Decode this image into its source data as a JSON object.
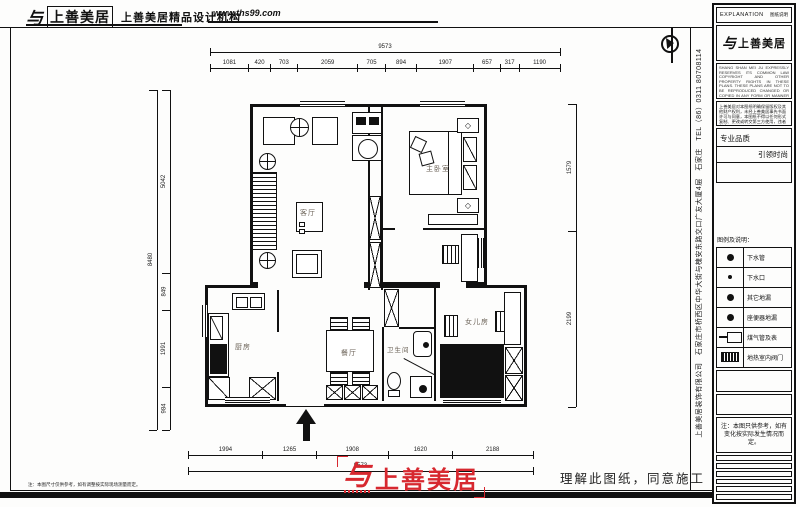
{
  "header": {
    "glyph": "与",
    "brand": "上善美居",
    "agency": "上善美居精品设计机构",
    "website": "www.ths99.com"
  },
  "panel": {
    "title_en": "EXPLANATION",
    "title_zh": "图纸说明",
    "logo_glyph": "与",
    "logo_text": "上善美居",
    "copyright_en": "SHANG SHAN MEI JU EXPRESSLY RESERVES ITS COMMON LAW COPYRIGHT AND OTHER PROPERTY RIGHTS IN THESE PLANS. THESE PLANS ARE NOT TO BE REPRODUCED CHANGED OR COPIED IN ANY FORM OR MANNER WHATSOEVER NOR ARE THEY TO BE ASSIGNED TO ANY THIRD PARTY WITHOUT FIRST OBTAINING THE EXPRESSED WRITTEN PERMISSION AND CONSENT OF SHANG SHAN MEI JU.",
    "copyright_zh": "上善美居对本图纸明确保留版权及其他财产权利，未经上善美居事先书面许可与同意，本图纸不得以任何形式复制、更改或转交第三方使用，违者必究。",
    "quality_top": "专业品质",
    "quality_bottom": "引领时尚",
    "legend_title": "图例及说明：",
    "legend": [
      {
        "symbol": "dot-large",
        "label": "下水管"
      },
      {
        "symbol": "dot-small",
        "label": "下水口"
      },
      {
        "symbol": "dot-large",
        "label": "其它地漏"
      },
      {
        "symbol": "dot-large",
        "label": "座便器地漏"
      },
      {
        "symbol": "gas-meter",
        "label": "煤气管及表"
      },
      {
        "symbol": "heat-valve",
        "label": "地热室内阀门"
      }
    ],
    "note": "注：本图只供参考，如有变化按实际发生情况而定。"
  },
  "plan": {
    "rooms": {
      "master": "主卧室",
      "living": "客厅",
      "kitchen": "厨房",
      "dining": "餐厅",
      "bath": "卫生间",
      "daughter": "女儿房"
    }
  },
  "dimensions": {
    "top_total": "9573",
    "top_segments": [
      "1081",
      "420",
      "703",
      "2059",
      "705",
      "894",
      "1907",
      "657",
      "317",
      "1190"
    ],
    "left_total": "8480",
    "left_segments": [
      "5042",
      "849",
      "1991",
      "984"
    ],
    "right_segments": [
      "1579",
      "2199"
    ],
    "bottom_segments": [
      "1994",
      "1265",
      "1908",
      "1620",
      "2188"
    ],
    "bottom_total": "9573"
  },
  "sidebar_company": "上善美居装饰有限公司　石家庄市桥西区中华大街与槐安东路交口广友大厦4层　石家庄　TEL（86）0311 80708114",
  "footer": {
    "note": "注：本图尺寸仅供参考，如有调整按实际现场测量而定。",
    "logo_glyph": "与",
    "logo_text": "上善美居",
    "slogan": "理解此图纸，同意施工"
  }
}
